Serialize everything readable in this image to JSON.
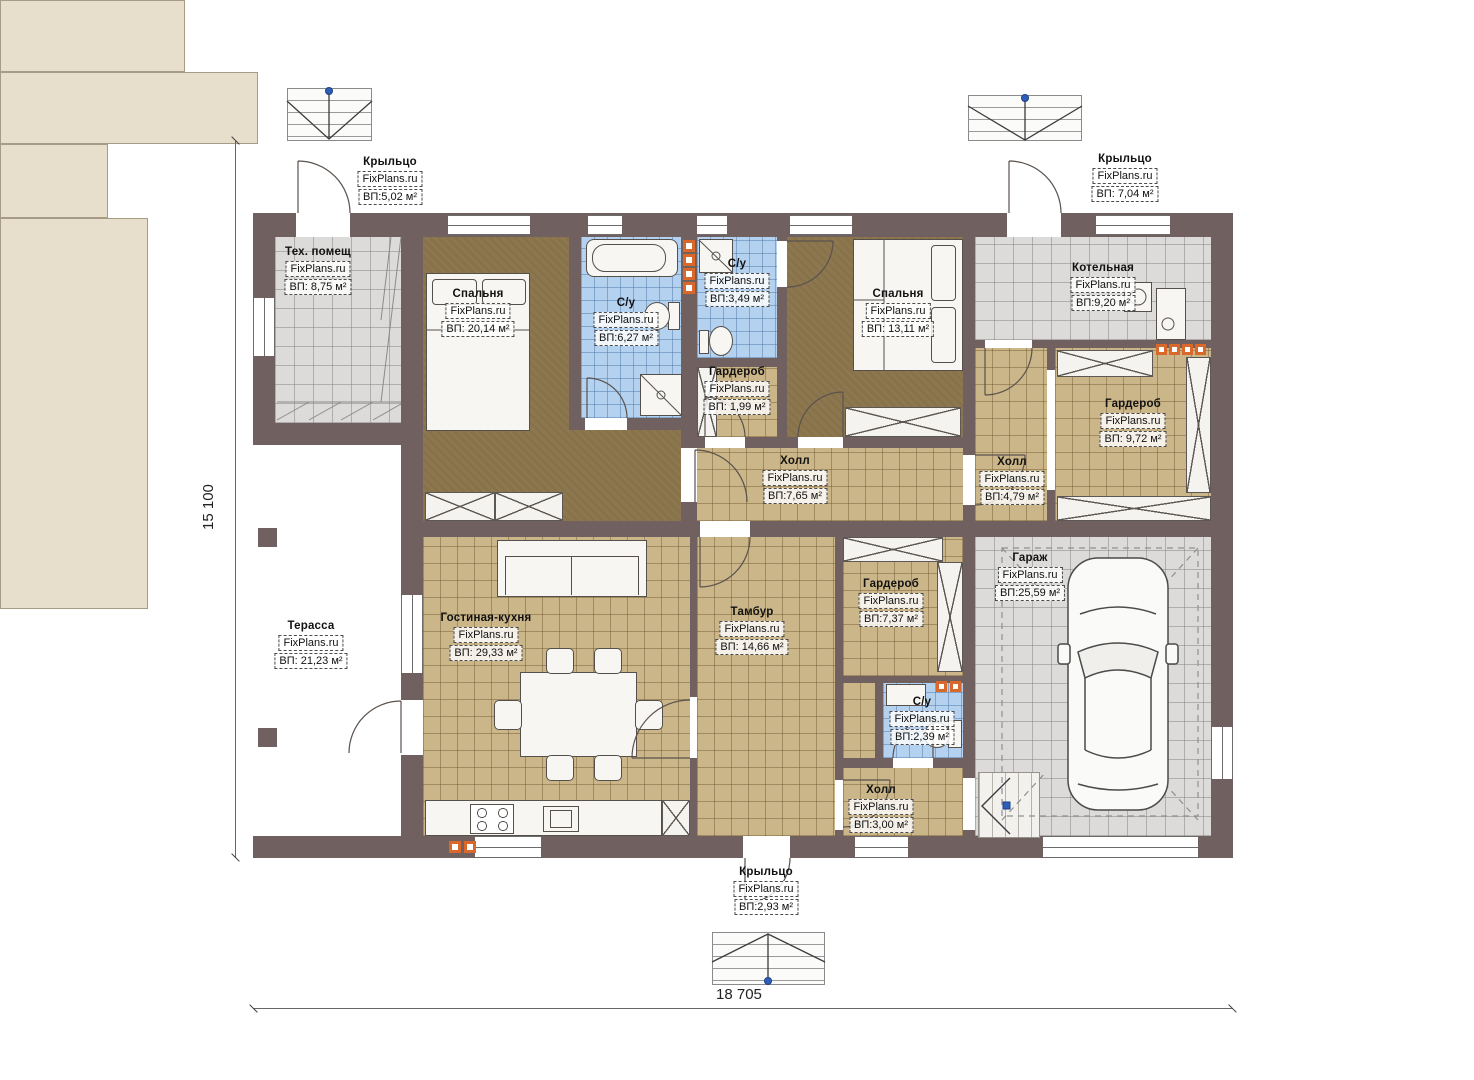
{
  "watermark": "FixPlans.ru",
  "dimensions": {
    "width": "18 705",
    "height": "15 100"
  },
  "colors": {
    "wall": "#716060",
    "floor_tan": "#cbb689",
    "floor_gray": "#dcdbd9",
    "floor_blue": "#b4d2ef",
    "floor_brown": "#8c774f",
    "outdoor_beige": "#e7decb",
    "vent_orange": "#d9682a",
    "marker_blue": "#2e5fb8"
  },
  "rooms": {
    "porch_tl": {
      "name": "Крыльцо",
      "area": "ВП:5,02 м²"
    },
    "porch_tr": {
      "name": "Крыльцо",
      "area": "ВП: 7,04 м²"
    },
    "porch_b": {
      "name": "Крыльцо",
      "area": "ВП:2,93 м²"
    },
    "tech": {
      "name": "Тех. помещ",
      "area": "ВП: 8,75 м²"
    },
    "bedroom1": {
      "name": "Спальня",
      "area": "ВП: 20,14 м²"
    },
    "bath1": {
      "name": "С/у",
      "area": "ВП:6,27 м²"
    },
    "bath2": {
      "name": "С/у",
      "area": "ВП:3,49 м²"
    },
    "wardrobe1": {
      "name": "Гардероб",
      "area": "ВП: 1,99 м²"
    },
    "bedroom2": {
      "name": "Спальня",
      "area": "ВП: 13,11 м²"
    },
    "boiler": {
      "name": "Котельная",
      "area": "ВП:9,20 м²"
    },
    "hall_center": {
      "name": "Холл",
      "area": "ВП:7,65 м²"
    },
    "hall_right": {
      "name": "Холл",
      "area": "ВП:4,79 м²"
    },
    "wardrobe2": {
      "name": "Гардероб",
      "area": "ВП: 9,72 м²"
    },
    "terrace": {
      "name": "Терасса",
      "area": "ВП: 21,23 м²"
    },
    "living": {
      "name": "Гостиная-кухня",
      "area": "ВП: 29,33 м²"
    },
    "tambour": {
      "name": "Тамбур",
      "area": "ВП: 14,66 м²"
    },
    "wardrobe3": {
      "name": "Гардероб",
      "area": "ВП:7,37 м²"
    },
    "bath3": {
      "name": "С/у",
      "area": "ВП:2,39 м²"
    },
    "hall_bottom": {
      "name": "Холл",
      "area": "ВП:3,00 м²"
    },
    "garage": {
      "name": "Гараж",
      "area": "ВП:25,59 м²"
    }
  }
}
